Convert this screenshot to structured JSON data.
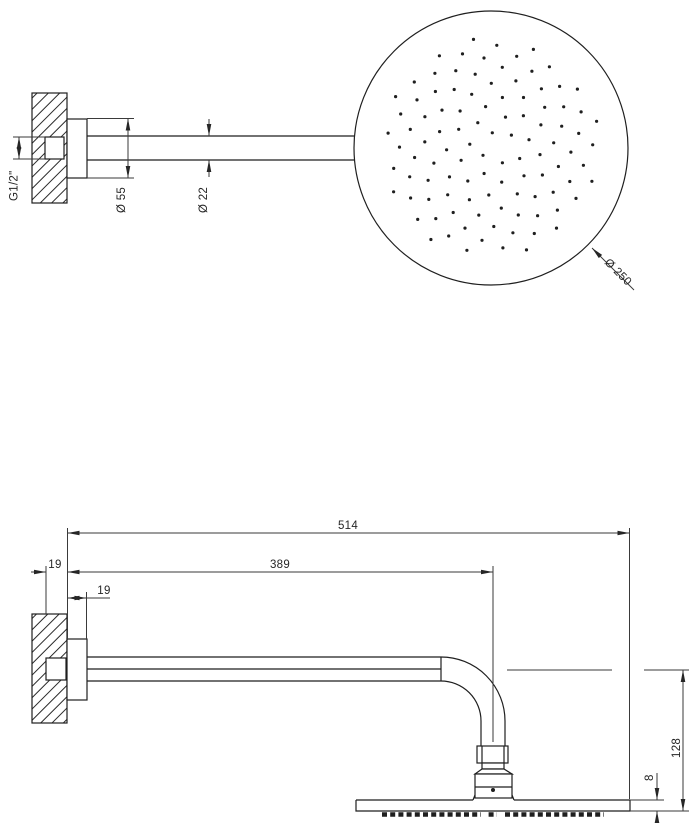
{
  "drawing": {
    "type": "technical-drawing",
    "subject": "wall-mounted-shower-head",
    "views": {
      "top": {
        "labels": {
          "thread": "G1/2\"",
          "flange_diameter": "Ø 55",
          "arm_diameter": "Ø 22",
          "head_diameter": "Ø 250"
        },
        "nozzle_pattern": {
          "arrangement": "phyllotaxis",
          "count": 104,
          "max_radius_px": 110,
          "dot_radius_px": 1.6,
          "golden_angle_deg": 137.508
        }
      },
      "bottom": {
        "labels": {
          "total_projection": "514",
          "arm_projection": "389",
          "inlet_depth": "19",
          "flange_depth": "19",
          "head_drop": "128",
          "head_thickness": "8"
        }
      }
    },
    "colors": {
      "line": "#1f1f1f",
      "dim": "#3a3a3a",
      "background": "#ffffff"
    }
  }
}
